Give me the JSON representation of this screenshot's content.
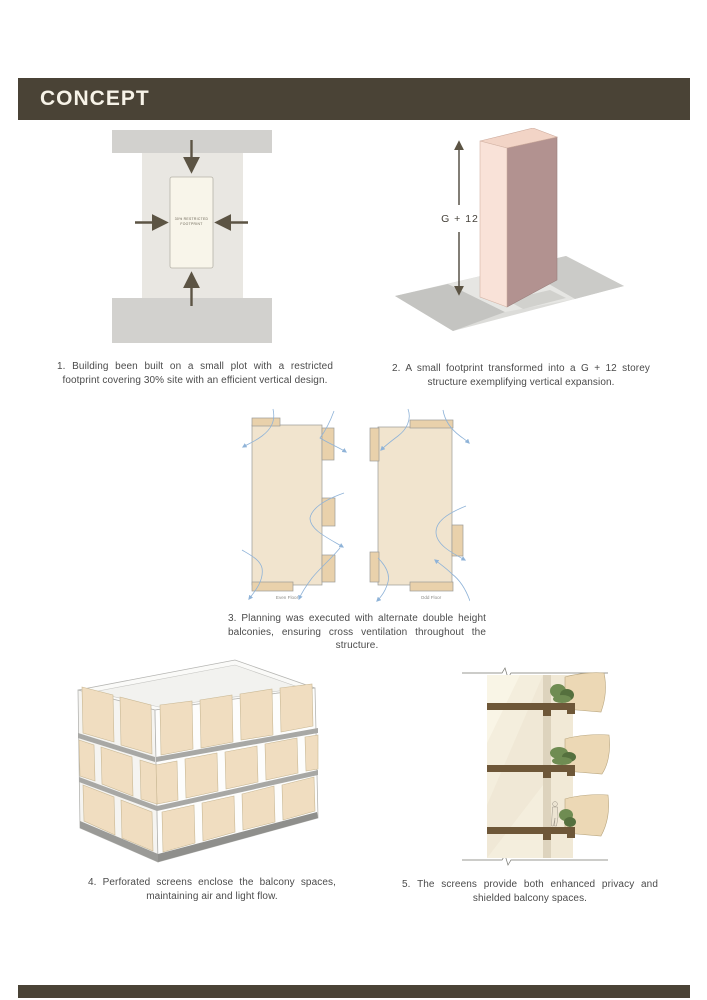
{
  "header": {
    "title": "CONCEPT"
  },
  "captions": {
    "c1": "1. Building been built on a small plot with a restricted footprint covering 30% site with an efficient vertical design.",
    "c2": "2. A small footprint transformed into a G + 12 storey structure exemplifying vertical expansion.",
    "c3": "3. Planning was executed with alternate double height balconies, ensuring cross ventilation throughout the structure.",
    "c4": "4. Perforated screens enclose the balcony spaces, maintaining air and light flow.",
    "c5": "5. The screens provide both enhanced privacy and shielded balcony spaces."
  },
  "figures": {
    "plot": {
      "footprint_line1": "30% RESTRICTED",
      "footprint_line2": "FOOTPRINT"
    },
    "tower": {
      "height_label": "G + 12"
    },
    "plans": {
      "left_label": "Even Floor",
      "right_label": "Odd Floor"
    }
  },
  "icons": {
    "compression_arrows": "inward solid arrows (up/down/left/right)",
    "height_extent_arrow": "double-headed vertical arrow",
    "airflow_arrow": "curved wind-flow arrow"
  },
  "theme": {
    "header_bg": "#4a4336",
    "header_text": "#f7f3e8",
    "caption_text": "#4b4b4b",
    "arrow_dark": "#5c5444",
    "airflow_blue": "#8fb3d8",
    "site_gray": "#d2d1ce",
    "site_strip": "#e9e7e2",
    "footprint_fill": "#f8f5ea",
    "tower_front": "#f9e2d8",
    "tower_side": "#b29290",
    "tower_top": "#f2d4c6",
    "plan_fill": "#f1e4ce",
    "balcony_fill": "#e9d1ab",
    "screen_tan": "#f0ddc0",
    "slab_brown": "#6e5738",
    "plant_green": "#6f8c52"
  }
}
